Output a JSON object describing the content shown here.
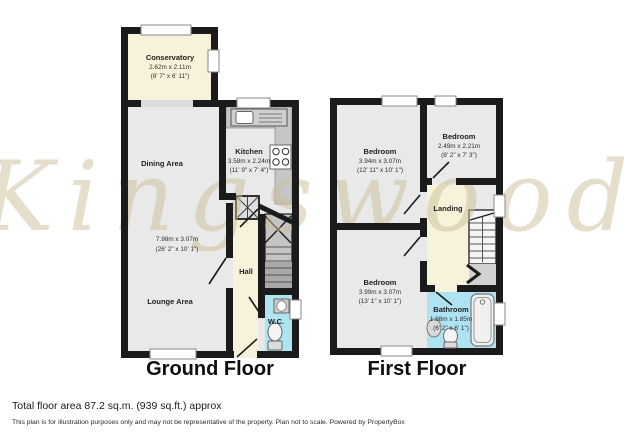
{
  "watermark": "Kingswood",
  "ground": {
    "label": "Ground Floor",
    "rooms": {
      "conservatory": {
        "name": "Conservatory",
        "metric": "2.62m x 2.11m",
        "imperial": "(8' 7\" x 6' 11\")"
      },
      "kitchen": {
        "name": "Kitchen",
        "metric": "3.58m x 2.24m",
        "imperial": "(11' 9\" x 7' 4\")"
      },
      "dining": {
        "name": "Dining Area"
      },
      "lounge_dining": {
        "metric": "7.98m x 3.07m",
        "imperial": "(26' 2\" x 10' 1\")"
      },
      "lounge": {
        "name": "Lounge Area"
      },
      "hall": {
        "name": "Hall"
      },
      "wc": {
        "name": "W.C."
      }
    }
  },
  "first": {
    "label": "First Floor",
    "rooms": {
      "bedroom_front": {
        "name": "Bedroom",
        "metric": "3.94m x 3.07m",
        "imperial": "(12' 11\" x 10' 1\")"
      },
      "bedroom_small": {
        "name": "Bedroom",
        "metric": "2.49m x 2.21m",
        "imperial": "(8' 2\" x 7' 3\")"
      },
      "bedroom_rear": {
        "name": "Bedroom",
        "metric": "3.99m x 3.07m",
        "imperial": "(13' 1\" x 10' 1\")"
      },
      "landing": {
        "name": "Landing"
      },
      "bathroom": {
        "name": "Bathroom",
        "metric": "1.88m x 1.85m",
        "imperial": "(6' 2\" x 6' 1\")"
      }
    }
  },
  "footer": {
    "total_area": "Total floor area 87.2 sq.m. (939 sq.ft.) approx",
    "disclaimer": "This plan is for illustration purposes only and may not be representative of the property. Plan not to scale. Powered by PropertyBox"
  },
  "colors": {
    "wall": "#1b1b1b",
    "room_fill": "#e9e9e9",
    "hall_fill": "#f7f2da",
    "wet_room_fill": "#aee3f2",
    "counter_fill": "#c6c6c6",
    "watermark": "#c9bd97"
  }
}
